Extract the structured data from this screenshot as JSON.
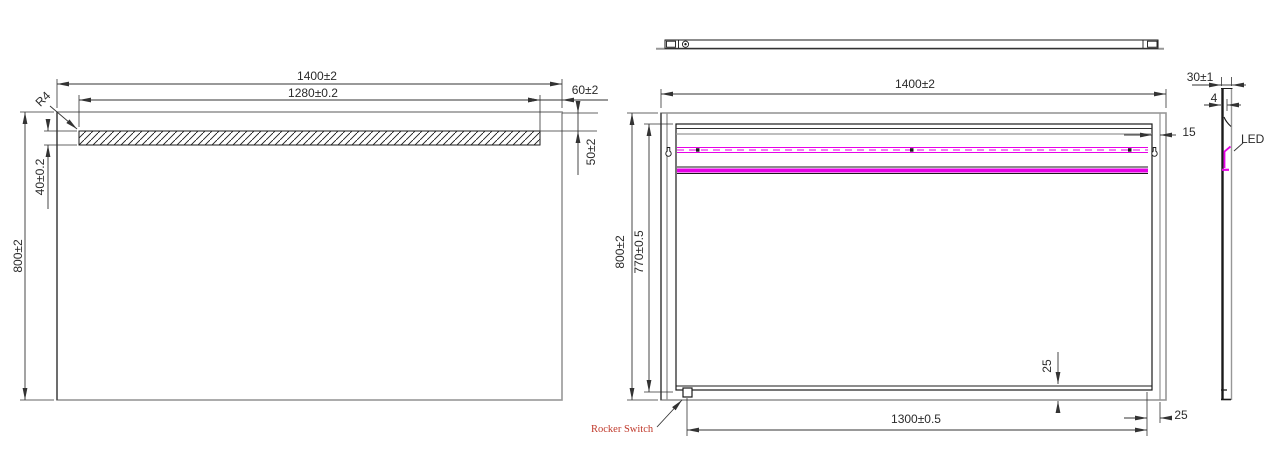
{
  "colors": {
    "body_line_grey": "#979797",
    "drawing_black": "#1a1a1a",
    "led_magenta": "#e600e6",
    "label_red": "#c0392b"
  },
  "front_view": {
    "dim_width_outer": "1400±2",
    "dim_width_led_window": "1280±0.2",
    "dim_led_right_offset": "60±2",
    "dim_led_top_offset": "50±2",
    "dim_led_window_height": "40±0.2",
    "dim_height": "800±2",
    "corner_radius": "R4"
  },
  "back_view": {
    "dim_width": "1400±2",
    "dim_height": "800±2",
    "dim_inner_frame_height": "770±0.5",
    "dim_edge_gap": "15",
    "dim_bottom_gap": "25",
    "dim_switch_span": "1300±0.5",
    "dim_right_gap": "25",
    "switch_label": "Rocker Switch"
  },
  "side_view": {
    "dim_depth": "30±1",
    "dim_glass_thickness": "4",
    "led_label": "LED"
  }
}
